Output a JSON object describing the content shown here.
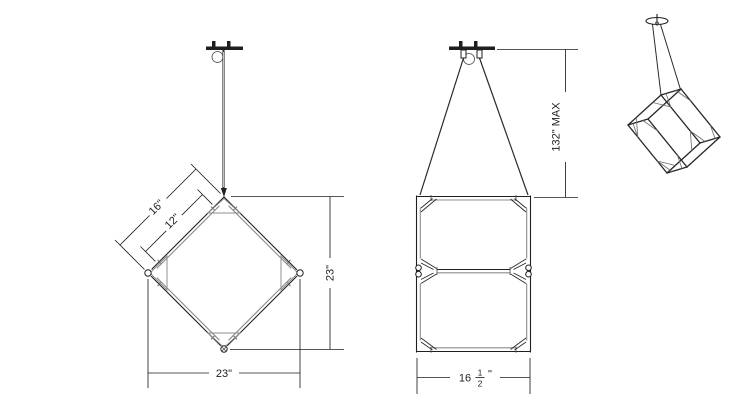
{
  "drawing": {
    "background": "#ffffff",
    "line_color": "#1f1f1f",
    "secondary_line_color": "#8c8c8c"
  },
  "front_view": {
    "dim_edge_outer": "16\"",
    "dim_edge_inner": "12\"",
    "dim_height": "23\"",
    "dim_width": "23\""
  },
  "side_view": {
    "dim_drop": "132\" MAX",
    "dim_width_whole": "16",
    "dim_width_num": "1",
    "dim_width_den": "2",
    "dim_width_unit": "\""
  }
}
